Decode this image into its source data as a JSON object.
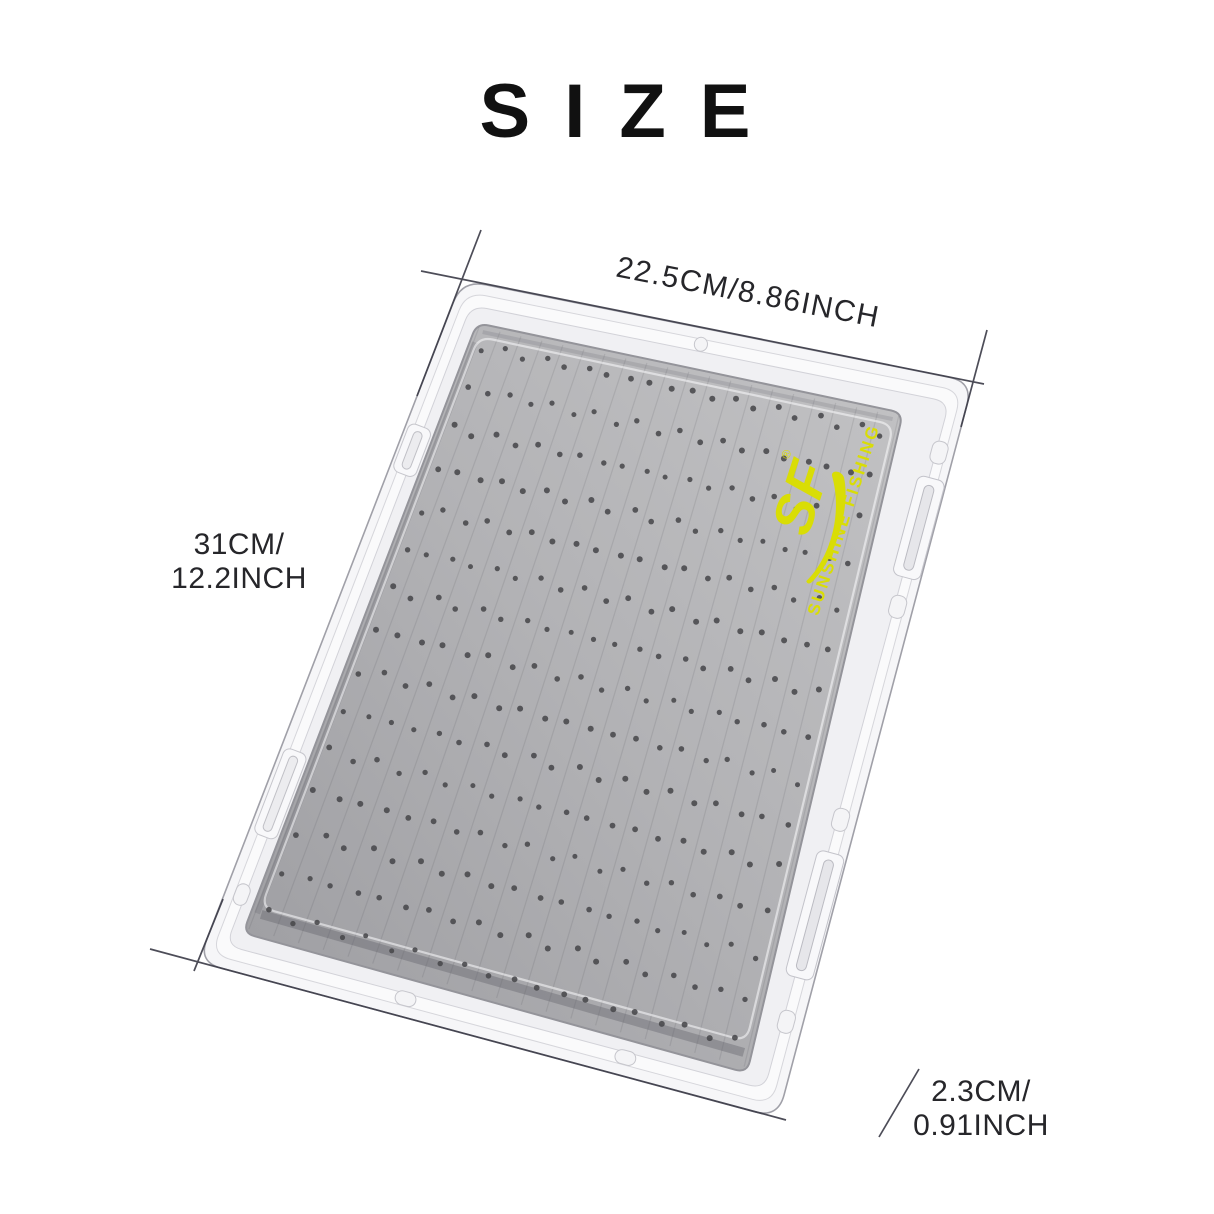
{
  "title": "SIZE",
  "dimensions": {
    "width_label": "22.5CM/8.86INCH",
    "height_label_line1": "31CM/",
    "height_label_line2": "12.2INCH",
    "depth_label_line1": "2.3CM/",
    "depth_label_line2": "0.91INCH"
  },
  "product": {
    "logo": {
      "brand_initials": "SF",
      "registered_mark": "®",
      "brand_name": "SUNSHINE FISHING",
      "color": "#d9dd05"
    },
    "colors": {
      "background": "#ffffff",
      "case_fill": "#f6f6f8",
      "case_edge": "#a0a0a8",
      "rim_line": "#d6d6db",
      "rim_fill": "#f0f0f3",
      "foam_light": "#c1c1c3",
      "foam_mid": "#b2b2b5",
      "foam_dark": "#a0a0a4",
      "hole": "#48484b",
      "dimension_line": "#3e3e4a",
      "label_text": "#26262a",
      "title_text": "#111111"
    }
  }
}
